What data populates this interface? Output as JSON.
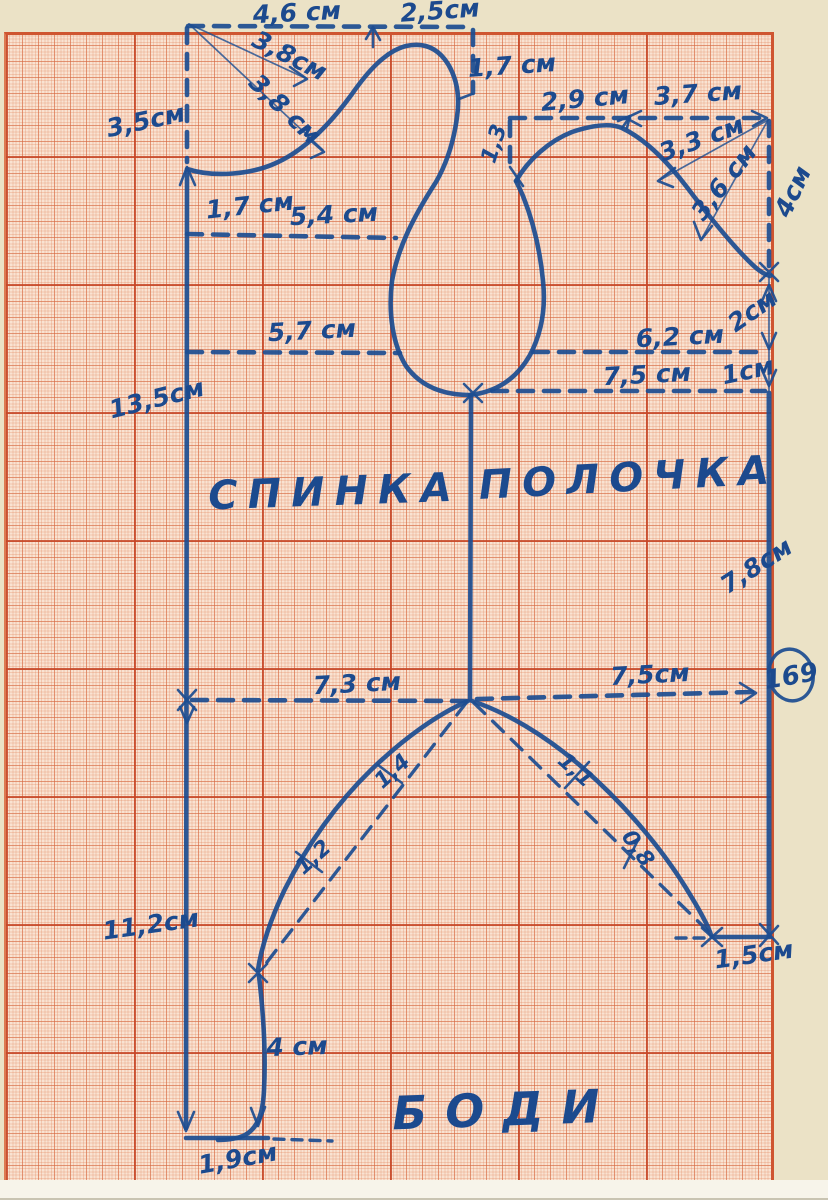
{
  "pattern": {
    "back_piece_label": "СПИНКА",
    "front_piece_label": "ПОЛОЧКА",
    "garment_title": "БОДИ",
    "page_number_badge": "169"
  },
  "back": {
    "top_width_left": "4,6 см",
    "top_width_right": "2,5см",
    "neck_diag_upper": "3,8см",
    "neck_diag_lower": "3,8 см",
    "side_top": "3,5см",
    "neck_drop_right": "1,7 см",
    "shoulder_drop_left": "1,7 см",
    "upper_chest_line": "5,4 см",
    "bust_line": "5,7 см",
    "side_length": "13,5см",
    "waist_line": "7,3 см",
    "lower_side_length": "11,2см",
    "leg_inner_length": "4 см",
    "bottom_width": "1,9см",
    "leg_curve_gap_upper": "1,4",
    "leg_curve_gap_lower": "1,2"
  },
  "front": {
    "top_width_left": "2,9 см",
    "top_width_right": "3,7 см",
    "neck_drop": "1,3",
    "shoulder_diag_upper": "3,3 см",
    "shoulder_diag_lower": "3,6 см",
    "armhole_depth": "4см",
    "side_upper": "2см",
    "bust_line": "6,2 см",
    "side_step": "1см",
    "hip_line_upper": "7,5 см",
    "side_length": "7,8см",
    "waist_line": "7,5см",
    "leg_curve_gap_upper": "1,1",
    "leg_curve_gap_lower": "0,8",
    "leg_bottom_width": "1,5см"
  }
}
